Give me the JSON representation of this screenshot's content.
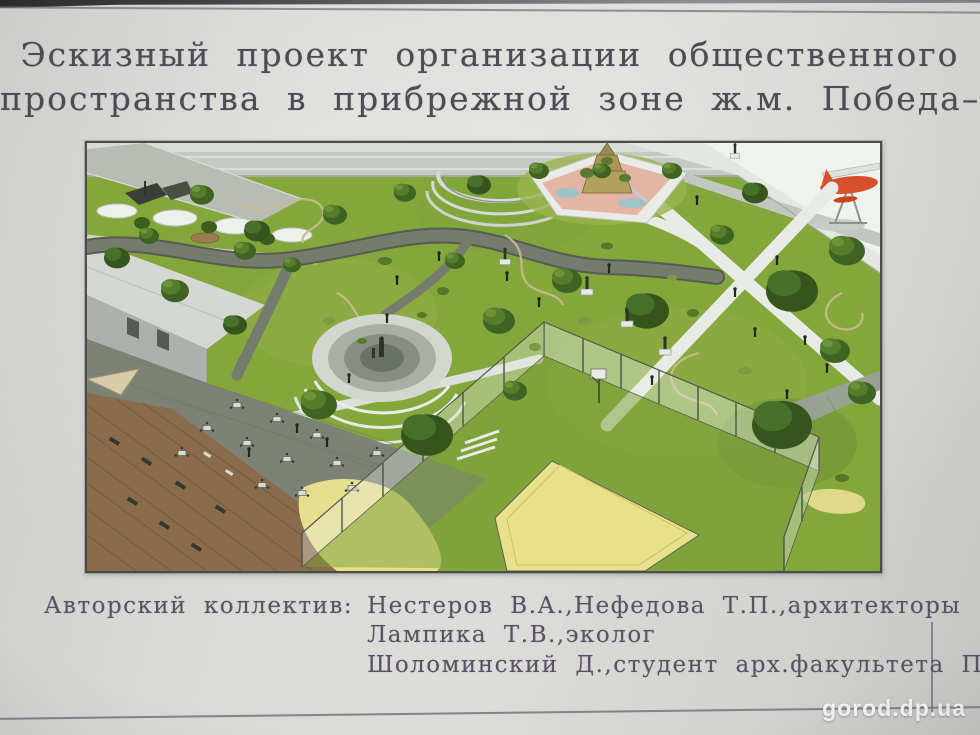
{
  "poster": {
    "title": {
      "line1": "Эскизный проект организации общественного",
      "line2": "пространства в прибрежной зоне ж.м. Победа–1"
    },
    "credits": {
      "label": "Авторский коллектив:",
      "entries": [
        "Нестеров В.А.,Нефедова Т.П.,архитекторы",
        "Лампика Т.В.,эколог",
        "Шоломинский Д.,студент арх.факультета ПГСА"
      ]
    },
    "watermark": "gorod.dp.ua",
    "render": {
      "scene_elements": [
        "lawn",
        "riverside-road",
        "waterfront",
        "seaplane-monument",
        "playground",
        "amphitheater",
        "central-plaza-with-statue",
        "cafe-terrace",
        "wooden-deck-with-loungers",
        "beach-sand",
        "sports-court",
        "glass-fence",
        "walking-paths",
        "trees",
        "statues",
        "visitors"
      ],
      "colors": {
        "paper": "#d5d5d2",
        "title_ink": "#4f4b55",
        "credits_ink": "#5a5264",
        "lawn": "#84a73c",
        "path_dark": "#6f766a",
        "path_light": "#e8eae5",
        "sand": "#e6df8e",
        "sports_field": "#e9e189",
        "deck_wood": "#8a6b4b",
        "seaplane_red": "#d7502c"
      }
    }
  }
}
